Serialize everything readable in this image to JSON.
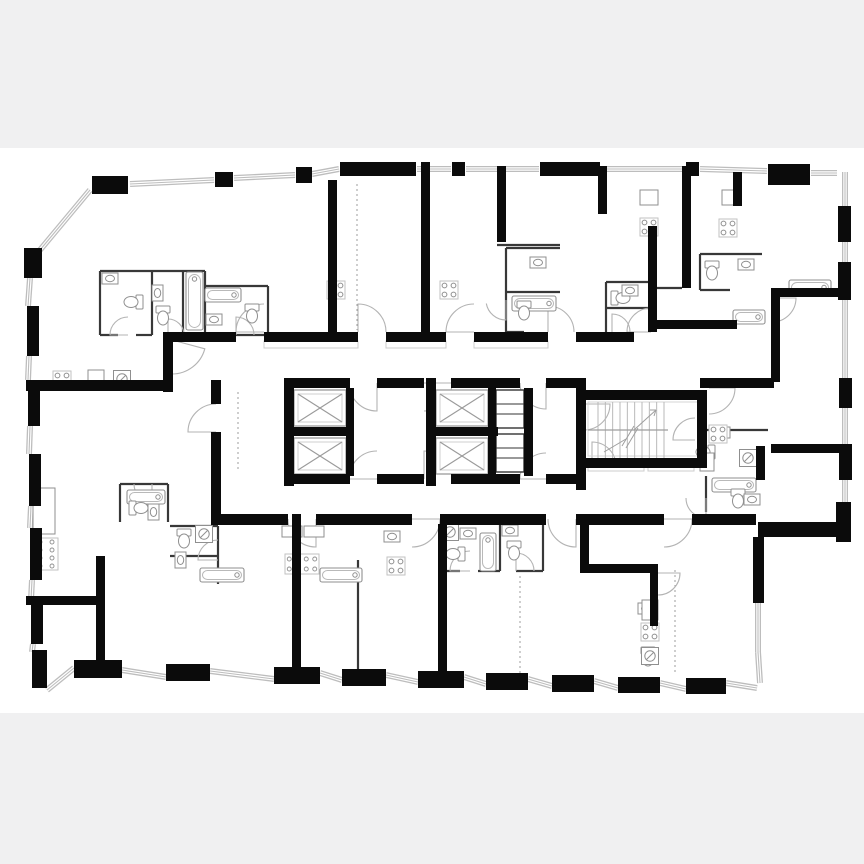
{
  "palette": {
    "page_bg": "#f0f0f1",
    "sheet_bg": "#ffffff",
    "wall": "#0b0b0b",
    "partition": "#383838",
    "window_gray": "#bdbdbd",
    "door_gray": "#b3b3b3",
    "fixture_gray": "#8f8f8f",
    "mat_gray": "#cccccc",
    "dotted_gray": "#9e9e9e",
    "stair_gray": "#b9b9b9",
    "elevator_gray": "#9a9a9a"
  },
  "sheet": {
    "x": 0,
    "y": 148,
    "w": 864,
    "h": 565
  },
  "floorplan": {
    "walls": [
      [
        92,
        176,
        36,
        18
      ],
      [
        215,
        172,
        18,
        15
      ],
      [
        296,
        167,
        16,
        16
      ],
      [
        340,
        162,
        76,
        14
      ],
      [
        452,
        162,
        13,
        14
      ],
      [
        540,
        162,
        60,
        14
      ],
      [
        686,
        162,
        13,
        14
      ],
      [
        768,
        164,
        42,
        21
      ],
      [
        24,
        248,
        18,
        30
      ],
      [
        27,
        306,
        12,
        50
      ],
      [
        28,
        380,
        12,
        46
      ],
      [
        29,
        454,
        12,
        52
      ],
      [
        30,
        528,
        12,
        52
      ],
      [
        31,
        600,
        12,
        44
      ],
      [
        32,
        650,
        15,
        38
      ],
      [
        838,
        206,
        13,
        36
      ],
      [
        838,
        262,
        13,
        38
      ],
      [
        839,
        378,
        13,
        30
      ],
      [
        839,
        444,
        13,
        36
      ],
      [
        836,
        502,
        15,
        40
      ],
      [
        758,
        522,
        92,
        15
      ],
      [
        753,
        537,
        11,
        66
      ],
      [
        74,
        660,
        48,
        18
      ],
      [
        166,
        664,
        44,
        17
      ],
      [
        274,
        667,
        46,
        17
      ],
      [
        342,
        669,
        44,
        17
      ],
      [
        418,
        671,
        46,
        17
      ],
      [
        486,
        673,
        42,
        17
      ],
      [
        552,
        675,
        42,
        17
      ],
      [
        618,
        677,
        42,
        16
      ],
      [
        686,
        678,
        40,
        16
      ],
      [
        328,
        180,
        9,
        152
      ],
      [
        421,
        162,
        9,
        180
      ],
      [
        497,
        166,
        9,
        76
      ],
      [
        598,
        166,
        9,
        48
      ],
      [
        648,
        226,
        9,
        106
      ],
      [
        682,
        166,
        9,
        122
      ],
      [
        733,
        172,
        9,
        34
      ],
      [
        771,
        288,
        9,
        94
      ],
      [
        776,
        288,
        70,
        9
      ],
      [
        651,
        320,
        86,
        9
      ],
      [
        700,
        378,
        74,
        10
      ],
      [
        756,
        446,
        9,
        34
      ],
      [
        771,
        444,
        70,
        9
      ],
      [
        163,
        332,
        10,
        60
      ],
      [
        172,
        332,
        64,
        10
      ],
      [
        264,
        332,
        94,
        10
      ],
      [
        386,
        332,
        60,
        10
      ],
      [
        474,
        332,
        74,
        10
      ],
      [
        576,
        332,
        58,
        10
      ],
      [
        26,
        380,
        146,
        11
      ],
      [
        211,
        380,
        10,
        24
      ],
      [
        211,
        432,
        10,
        42
      ],
      [
        211,
        474,
        10,
        40
      ],
      [
        284,
        378,
        10,
        108
      ],
      [
        284,
        378,
        66,
        10
      ],
      [
        377,
        378,
        47,
        10
      ],
      [
        451,
        378,
        69,
        10
      ],
      [
        546,
        378,
        40,
        10
      ],
      [
        284,
        474,
        66,
        10
      ],
      [
        377,
        474,
        47,
        10
      ],
      [
        451,
        474,
        69,
        10
      ],
      [
        546,
        474,
        40,
        10
      ],
      [
        346,
        388,
        8,
        88
      ],
      [
        284,
        427,
        70,
        9
      ],
      [
        426,
        378,
        10,
        108
      ],
      [
        488,
        388,
        8,
        88
      ],
      [
        426,
        427,
        72,
        9
      ],
      [
        524,
        388,
        9,
        88
      ],
      [
        576,
        378,
        10,
        112
      ],
      [
        576,
        390,
        131,
        10
      ],
      [
        576,
        458,
        131,
        10
      ],
      [
        697,
        390,
        10,
        78
      ],
      [
        211,
        514,
        77,
        11
      ],
      [
        316,
        514,
        96,
        11
      ],
      [
        440,
        514,
        106,
        11
      ],
      [
        576,
        514,
        88,
        11
      ],
      [
        692,
        514,
        64,
        11
      ],
      [
        292,
        514,
        9,
        156
      ],
      [
        438,
        524,
        9,
        150
      ],
      [
        580,
        514,
        9,
        58
      ],
      [
        580,
        564,
        78,
        9
      ],
      [
        650,
        564,
        8,
        62
      ],
      [
        96,
        556,
        9,
        108
      ],
      [
        26,
        596,
        74,
        9
      ]
    ],
    "partitions": [
      [
        100,
        271,
        205,
        271
      ],
      [
        100,
        271,
        100,
        335
      ],
      [
        152,
        271,
        152,
        335
      ],
      [
        183,
        271,
        183,
        335
      ],
      [
        205,
        271,
        205,
        335
      ],
      [
        100,
        335,
        118,
        335
      ],
      [
        136,
        335,
        152,
        335
      ],
      [
        183,
        335,
        205,
        335
      ],
      [
        205,
        286,
        268,
        286
      ],
      [
        268,
        286,
        268,
        335
      ],
      [
        236,
        335,
        268,
        335
      ],
      [
        506,
        248,
        560,
        248
      ],
      [
        506,
        248,
        506,
        332
      ],
      [
        506,
        292,
        560,
        292
      ],
      [
        506,
        332,
        524,
        332
      ],
      [
        606,
        282,
        648,
        282
      ],
      [
        606,
        282,
        606,
        332
      ],
      [
        606,
        308,
        648,
        308
      ],
      [
        700,
        254,
        762,
        254
      ],
      [
        700,
        254,
        700,
        290
      ],
      [
        700,
        290,
        730,
        290
      ],
      [
        697,
        430,
        768,
        430
      ],
      [
        706,
        476,
        706,
        512
      ],
      [
        120,
        484,
        168,
        484
      ],
      [
        168,
        484,
        168,
        522
      ],
      [
        120,
        484,
        120,
        522
      ],
      [
        170,
        526,
        218,
        526
      ],
      [
        218,
        526,
        218,
        584
      ],
      [
        170,
        556,
        218,
        556
      ],
      [
        443,
        525,
        443,
        571
      ],
      [
        500,
        525,
        500,
        571
      ],
      [
        543,
        525,
        543,
        571
      ],
      [
        443,
        571,
        460,
        571
      ],
      [
        478,
        571,
        500,
        571
      ],
      [
        516,
        571,
        543,
        571
      ],
      [
        358,
        560,
        358,
        672
      ],
      [
        497,
        245,
        560,
        245
      ],
      [
        651,
        288,
        682,
        288
      ]
    ],
    "dotted": [
      [
        357,
        184,
        357,
        330
      ],
      [
        675,
        570,
        675,
        674
      ],
      [
        520,
        576,
        520,
        674
      ],
      [
        238,
        392,
        238,
        470
      ]
    ],
    "windows": [
      [
        130,
        184,
        214,
        180
      ],
      [
        234,
        178,
        295,
        175
      ],
      [
        312,
        174,
        339,
        169
      ],
      [
        417,
        169,
        451,
        169
      ],
      [
        466,
        169,
        539,
        169
      ],
      [
        601,
        169,
        685,
        169
      ],
      [
        700,
        169,
        767,
        171
      ],
      [
        811,
        173,
        837,
        173
      ],
      [
        40,
        250,
        90,
        190
      ],
      [
        30,
        278,
        28,
        306
      ],
      [
        29,
        356,
        28,
        380
      ],
      [
        30,
        426,
        29,
        454
      ],
      [
        31,
        506,
        30,
        528
      ],
      [
        32,
        580,
        31,
        600
      ],
      [
        33,
        644,
        32,
        652
      ],
      [
        845,
        172,
        845,
        206
      ],
      [
        845,
        242,
        845,
        262
      ],
      [
        845,
        300,
        845,
        378
      ],
      [
        845,
        408,
        845,
        444
      ],
      [
        845,
        480,
        845,
        502
      ],
      [
        758,
        603,
        758,
        652
      ],
      [
        758,
        652,
        760,
        683
      ],
      [
        47,
        690,
        74,
        668
      ],
      [
        122,
        670,
        166,
        677
      ],
      [
        210,
        671,
        274,
        679
      ],
      [
        320,
        673,
        342,
        680
      ],
      [
        386,
        675,
        418,
        682
      ],
      [
        464,
        677,
        486,
        684
      ],
      [
        528,
        679,
        552,
        686
      ],
      [
        594,
        681,
        618,
        688
      ],
      [
        660,
        683,
        686,
        689
      ],
      [
        726,
        683,
        757,
        688
      ]
    ],
    "mats": [
      [
        264,
        341,
        94,
        7
      ],
      [
        386,
        341,
        60,
        7
      ],
      [
        474,
        341,
        74,
        7
      ],
      [
        588,
        463,
        56,
        8
      ],
      [
        648,
        463,
        46,
        8
      ]
    ],
    "elevators": [
      [
        294,
        390,
        52,
        36
      ],
      [
        294,
        438,
        52,
        36
      ],
      [
        436,
        390,
        52,
        36
      ],
      [
        436,
        438,
        52,
        36
      ]
    ],
    "shaft_boxes": [
      [
        496,
        390,
        28,
        38
      ],
      [
        496,
        434,
        28,
        38
      ]
    ],
    "jambs": [
      [
        346,
        396,
        8,
        5
      ],
      [
        346,
        419,
        8,
        5
      ],
      [
        346,
        444,
        8,
        5
      ],
      [
        346,
        467,
        8,
        5
      ],
      [
        426,
        396,
        10,
        5
      ],
      [
        426,
        419,
        10,
        5
      ],
      [
        426,
        444,
        10,
        5
      ],
      [
        426,
        467,
        10,
        5
      ]
    ],
    "stairs": {
      "x": 598,
      "y": 402,
      "w": 66,
      "h": 56,
      "treads": 9,
      "mid": 430,
      "room": [
        588,
        402,
        117,
        54
      ]
    },
    "doors": [
      [
        264,
        332,
        28,
        180,
        270
      ],
      [
        358,
        332,
        28,
        270,
        360
      ],
      [
        474,
        332,
        28,
        180,
        270
      ],
      [
        548,
        332,
        26,
        270,
        360
      ],
      [
        651,
        332,
        24,
        180,
        270
      ],
      [
        172,
        340,
        34,
        15,
        90
      ],
      [
        377,
        383,
        28,
        90,
        180
      ],
      [
        424,
        383,
        28,
        0,
        90
      ],
      [
        377,
        479,
        28,
        180,
        270
      ],
      [
        424,
        479,
        28,
        270,
        360
      ],
      [
        546,
        383,
        26,
        90,
        180
      ],
      [
        546,
        479,
        26,
        180,
        270
      ],
      [
        316,
        519,
        28,
        90,
        180
      ],
      [
        412,
        519,
        28,
        0,
        90
      ],
      [
        576,
        519,
        28,
        90,
        180
      ],
      [
        664,
        519,
        28,
        0,
        90
      ],
      [
        216,
        432,
        28,
        180,
        270
      ],
      [
        592,
        466,
        24,
        270,
        360
      ],
      [
        584,
        404,
        26,
        0,
        90
      ],
      [
        128,
        335,
        18,
        180,
        270
      ],
      [
        168,
        335,
        16,
        270,
        360
      ],
      [
        236,
        335,
        18,
        270,
        360
      ],
      [
        506,
        300,
        20,
        90,
        170
      ],
      [
        612,
        332,
        18,
        270,
        360
      ],
      [
        695,
        440,
        22,
        180,
        270
      ],
      [
        706,
        498,
        20,
        90,
        180
      ],
      [
        152,
        484,
        18,
        90,
        180
      ],
      [
        218,
        560,
        20,
        180,
        270
      ],
      [
        470,
        571,
        20,
        180,
        270
      ],
      [
        516,
        571,
        18,
        270,
        360
      ],
      [
        772,
        298,
        24,
        0,
        90
      ],
      [
        709,
        388,
        26,
        0,
        90
      ],
      [
        658,
        573,
        22,
        0,
        90
      ]
    ],
    "fixtures": {
      "tubs": [
        [
          186,
          272,
          17,
          58
        ],
        [
          205,
          288,
          36,
          14
        ],
        [
          512,
          296,
          44,
          15
        ],
        [
          789,
          280,
          42,
          15
        ],
        [
          733,
          310,
          32,
          14
        ],
        [
          712,
          478,
          44,
          14
        ],
        [
          127,
          490,
          38,
          14
        ],
        [
          200,
          568,
          44,
          14
        ],
        [
          480,
          533,
          16,
          38
        ],
        [
          320,
          568,
          42,
          14
        ]
      ],
      "toilets": [
        [
          132,
          302,
          90
        ],
        [
          163,
          317,
          0
        ],
        [
          252,
          315,
          0
        ],
        [
          524,
          312,
          0
        ],
        [
          622,
          298,
          270
        ],
        [
          712,
          272,
          0
        ],
        [
          704,
          452,
          90
        ],
        [
          738,
          500,
          0
        ],
        [
          140,
          508,
          270
        ],
        [
          184,
          540,
          0
        ],
        [
          454,
          554,
          90
        ],
        [
          514,
          552,
          0
        ],
        [
          648,
          658,
          0
        ]
      ],
      "sinks": [
        [
          110,
          278,
          0
        ],
        [
          158,
          293,
          90
        ],
        [
          214,
          320,
          180
        ],
        [
          538,
          262,
          0
        ],
        [
          630,
          290,
          0
        ],
        [
          746,
          264,
          0
        ],
        [
          722,
          432,
          0
        ],
        [
          752,
          500,
          180
        ],
        [
          154,
          512,
          90
        ],
        [
          180,
          560,
          270
        ],
        [
          468,
          533,
          0
        ],
        [
          510,
          530,
          0
        ],
        [
          392,
          536,
          0
        ],
        [
          646,
          608,
          0
        ]
      ],
      "stoves4": [
        [
          62,
          380
        ],
        [
          336,
          290
        ],
        [
          449,
          290
        ],
        [
          649,
          227
        ],
        [
          728,
          228
        ],
        [
          396,
          566
        ],
        [
          650,
          632
        ],
        [
          718,
          434
        ]
      ],
      "stoves8": [
        [
          285,
          554,
          34,
          20
        ],
        [
          34,
          538,
          24,
          32
        ]
      ],
      "washers": [
        [
          122,
          379
        ],
        [
          204,
          534
        ],
        [
          450,
          532
        ],
        [
          650,
          656
        ],
        [
          748,
          458
        ]
      ],
      "boxes": [
        [
          88,
          370,
          16,
          14
        ],
        [
          640,
          190,
          18,
          15
        ],
        [
          722,
          190,
          16,
          15
        ],
        [
          642,
          600,
          16,
          20
        ],
        [
          33,
          488,
          22,
          46
        ],
        [
          282,
          526,
          20,
          11
        ],
        [
          304,
          526,
          20,
          11
        ],
        [
          700,
          453,
          14,
          18
        ]
      ]
    }
  }
}
